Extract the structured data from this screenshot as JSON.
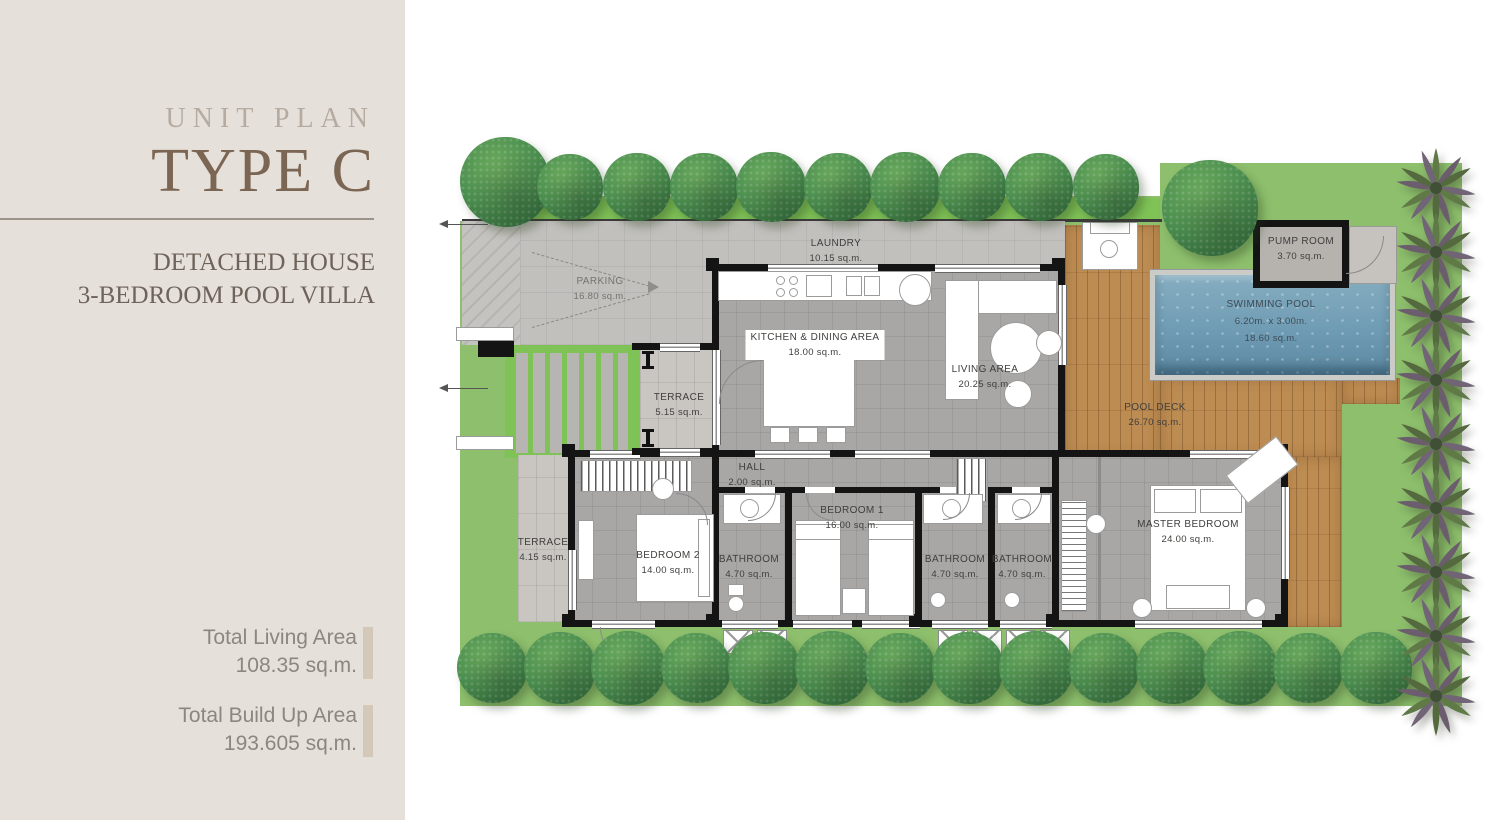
{
  "sidebar": {
    "eyebrow": "UNIT PLAN",
    "title": "TYPE C",
    "subtitle_line1": "DETACHED HOUSE",
    "subtitle_line2": "3-BEDROOM POOL VILLA",
    "stats": [
      {
        "label": "Total Living Area",
        "value": "108.35 sq.m."
      },
      {
        "label": "Total Build Up Area",
        "value": "193.605 sq.m."
      }
    ]
  },
  "rooms": {
    "parking": {
      "name": "PARKING",
      "area": "16.80 sq.m."
    },
    "laundry": {
      "name": "LAUNDRY",
      "area": "10.15 sq.m."
    },
    "kitchen_dining": {
      "name": "KITCHEN & DINING AREA",
      "area": "18.00 sq.m."
    },
    "living": {
      "name": "LIVING AREA",
      "area": "20.25 sq.m."
    },
    "pump_room": {
      "name": "PUMP ROOM",
      "area": "3.70 sq.m."
    },
    "swimming_pool": {
      "name": "SWIMMING POOL",
      "dimensions": "6.20m. x 3.00m.",
      "area": "18.60 sq.m."
    },
    "pool_deck": {
      "name": "POOL DECK",
      "area": "26.70 sq.m."
    },
    "terrace_front": {
      "name": "TERRACE",
      "area": "5.15 sq.m."
    },
    "hall": {
      "name": "HALL",
      "area": "2.00 sq.m."
    },
    "terrace_side": {
      "name": "TERRACE",
      "area": "4.15 sq.m."
    },
    "bedroom_2": {
      "name": "BEDROOM 2",
      "area": "14.00 sq.m."
    },
    "bathroom_1": {
      "name": "BATHROOM",
      "area": "4.70 sq.m."
    },
    "bedroom_1": {
      "name": "BEDROOM 1",
      "area": "16.00 sq.m."
    },
    "bathroom_2": {
      "name": "BATHROOM",
      "area": "4.70 sq.m."
    },
    "bathroom_3": {
      "name": "BATHROOM",
      "area": "4.70 sq.m."
    },
    "master_bedroom": {
      "name": "MASTER BEDROOM",
      "area": "24.00 sq.m."
    }
  },
  "colors": {
    "sidebar_bg": "#e6e0da",
    "title_brown": "#7b6553",
    "eyebrow_taupe": "#b5aba1",
    "subtitle_brown": "#6e635a",
    "stats_gray": "#8b8681",
    "stat_bar_beige": "#d4c9b8",
    "grass_green": "#8dbf6c",
    "grass_bright": "#7fc357",
    "deck_wood": "#bd8c52",
    "pool_blue": "#6f9cb4",
    "wall_black": "#141414",
    "pavement_gray": "#c2c0bd"
  }
}
